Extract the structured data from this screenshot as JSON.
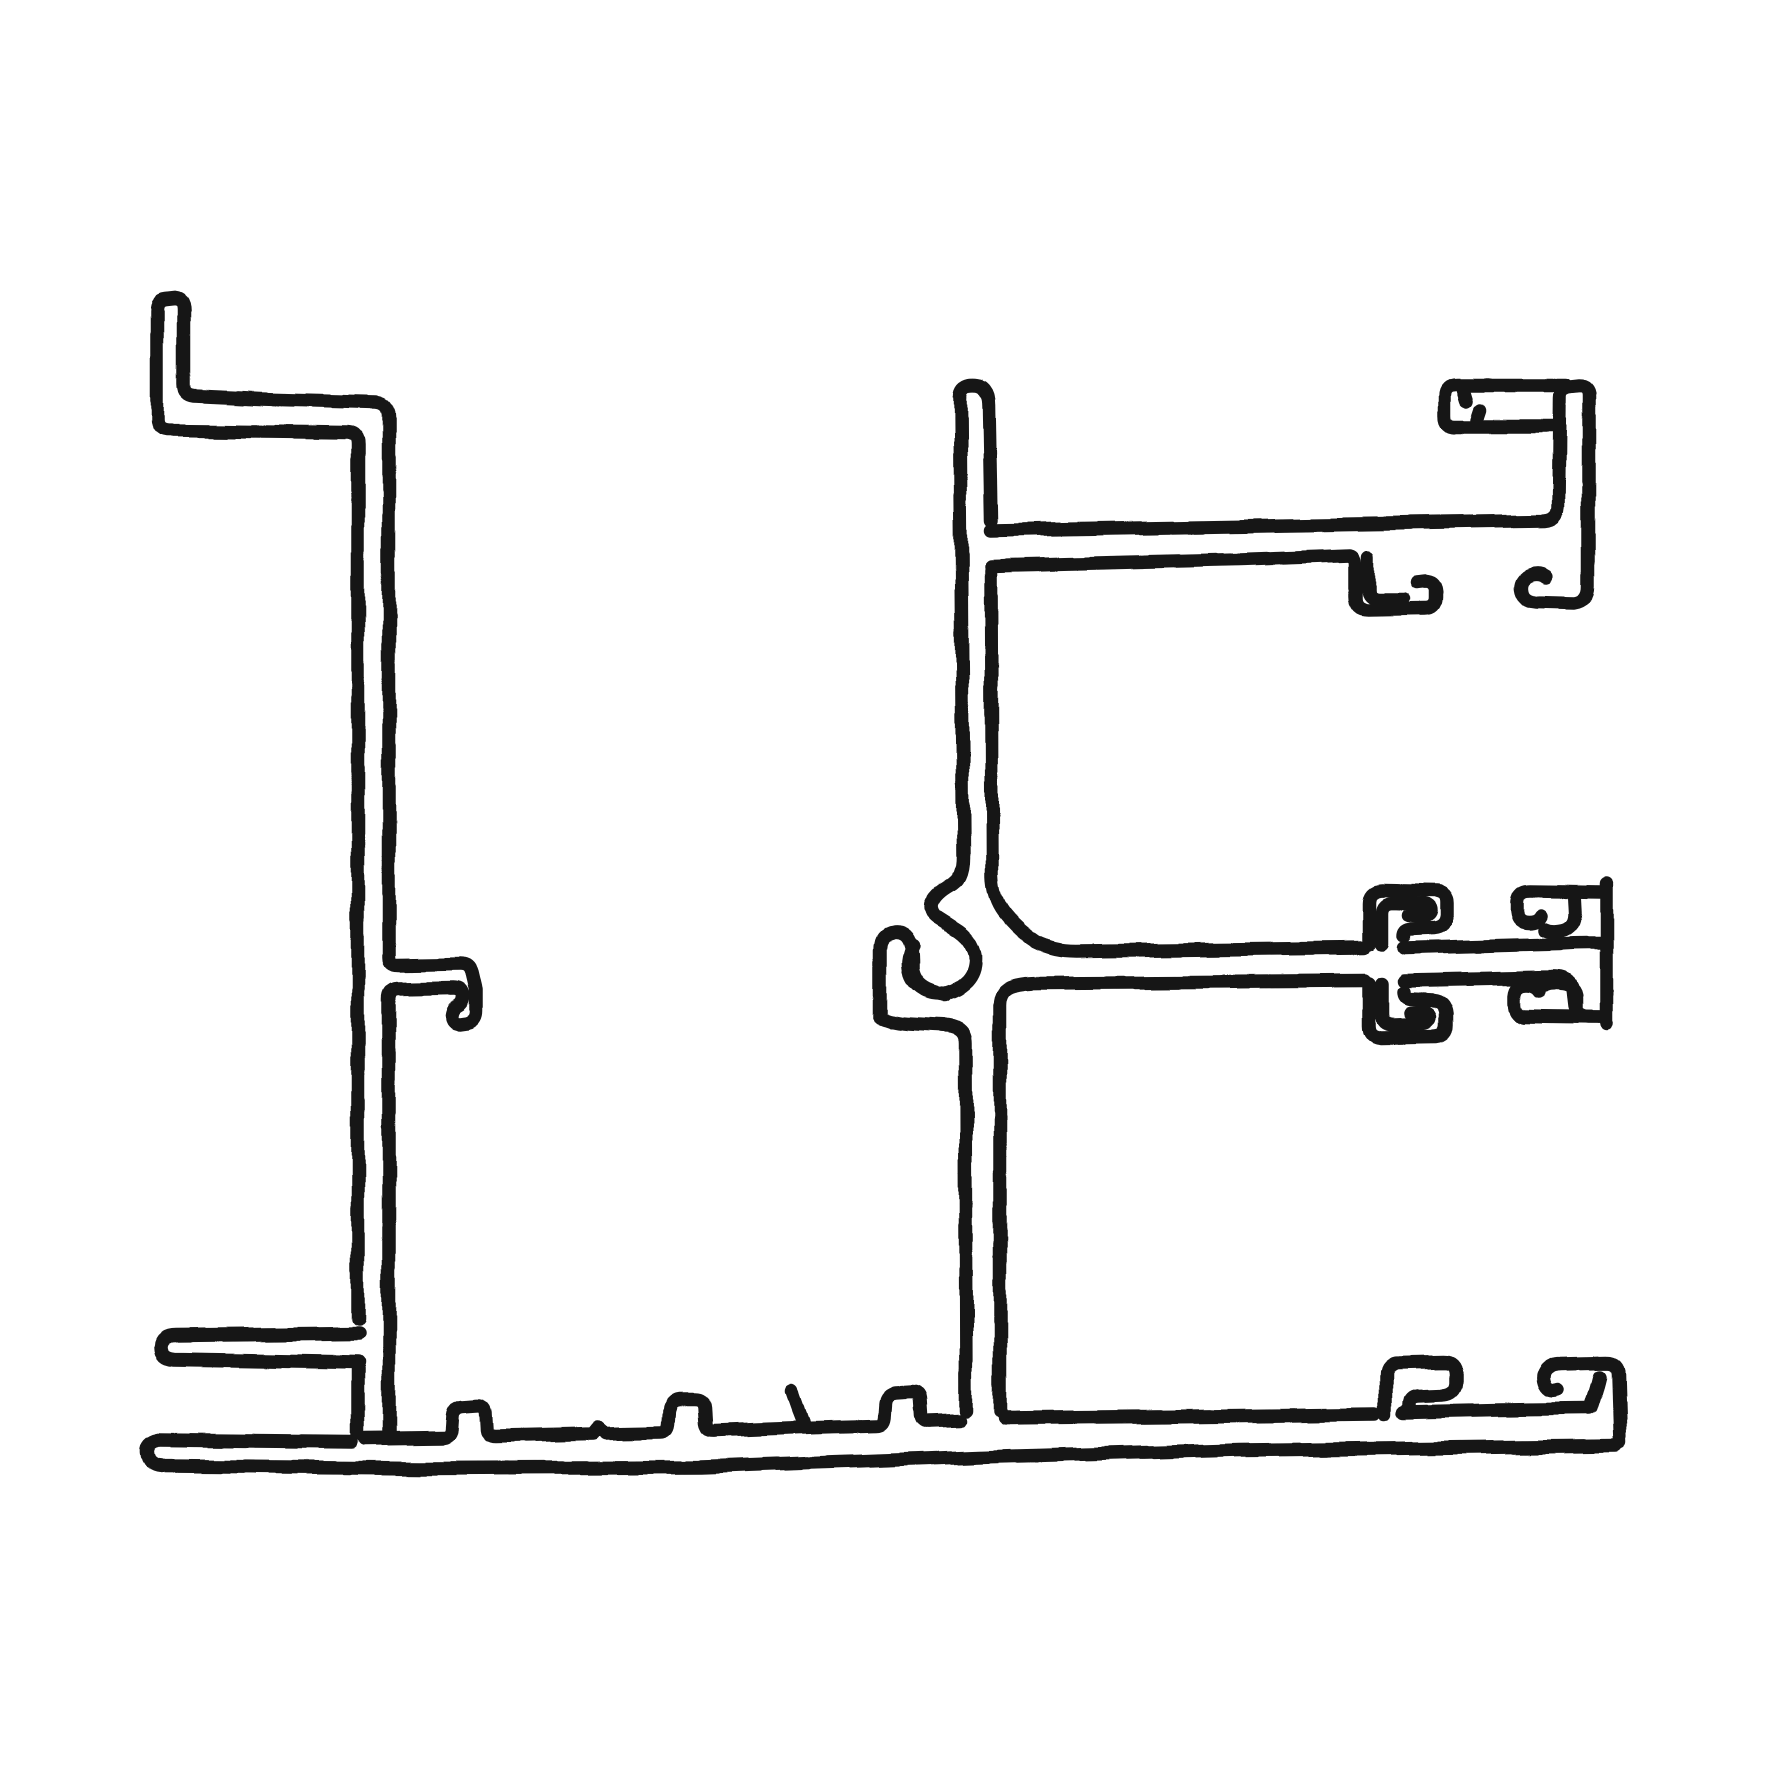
{
  "canvas": {
    "width": 1772,
    "height": 1772,
    "background": "#ffffff"
  },
  "drawing": {
    "description": "Hand-drawn black ink cross-section of an aluminium window-frame extrusion profile: a left Z-flanged upright, a long ribbed base sill, and a right upright carrying a glazing channel arm at top, a screw-boss hook and clip arm at middle, and bead-clip hooks at bottom right",
    "ink_color": "#191919",
    "stroke_width": 13.5,
    "paths": [
      {
        "name": "baseline-bottom-edge",
        "d": "M158,1440 Q146,1443 147,1453 Q148,1465 161,1466 L420,1468 L700,1467 L980,1457 L1240,1450 L1616,1446"
      },
      {
        "name": "baseline-top-edge-left",
        "d": "M158,1440 L352,1442"
      },
      {
        "name": "baseline-top-edge-mid-with-ribs",
        "d": "M366,1439 L442,1438 Q450,1438 451,1430 L452,1416 Q453,1407 462,1406 L476,1405 Q485,1404 486,1412 L487,1429 Q488,1436 496,1436 L592,1434 L598,1427 L605,1433 L661,1432 Q668,1432 669,1424 L670,1410 Q671,1401 680,1400 L695,1400 Q704,1400 705,1408 L706,1424 Q707,1431 715,1430 L800,1427 L876,1425 Q883,1425 884,1417 L885,1403 Q886,1394 895,1393 L911,1392 Q919,1392 920,1400 L921,1415 Q922,1422 930,1421 L960,1420"
      },
      {
        "name": "baseline-top-edge-right",
        "d": "M1004,1418 L1200,1416 L1376,1414"
      },
      {
        "name": "baseline-top-edge-far-right",
        "d": "M1404,1412 L1500,1410 L1589,1409"
      },
      {
        "name": "baseline-rib-flick",
        "d": "M791,1391 L797,1408 L804,1426"
      },
      {
        "name": "left-upright-outer-wall",
        "d": "M175,299 L166,300 Q157,301 157,311 L157,419 Q157,429 167,430 L348,432 Q358,433 358,444 L358,1320"
      },
      {
        "name": "left-bottom-finger",
        "d": "M358,1334 L176,1336 Q162,1336 161,1347 Q161,1358 174,1359 L358,1362"
      },
      {
        "name": "left-upright-wall-lower",
        "d": "M358,1368 L358,1434"
      },
      {
        "name": "left-upright-inner-wall-with-hook",
        "d": "M175,299 Q184,300 184,310 L184,385 Q184,395 194,396 L260,399 L376,402 Q389,403 389,417 L389,957 Q389,965 398,965 L461,964 Q470,964 472,973 L476,990 L476,1011 Q476,1021 466,1023 L459,1024 Q450,1024 451,1015 Q452,1008 458,1005 Q463,1002 463,995 Q462,988 454,988 L397,989 Q389,990 389,999 L389,1432"
      },
      {
        "name": "right-upright-cap-and-right-wall",
        "d": "M960,397 Q960,387 970,385 Q981,384 985,390 Q989,395 989,404 L991,520"
      },
      {
        "name": "right-upright-right-wall-to-clip-arm",
        "d": "M991,570 L992,876 Q993,900 1006,915 Q1019,931 1036,942 Q1054,951 1076,951 L1364,948"
      },
      {
        "name": "right-upright-left-wall-boss-curl",
        "d": "M960,397 L963,856 Q963,879 950,885 Q936,893 932,903 Q930,912 938,918 Q946,923 955,929 Q972,939 975,956 Q976,971 967,981 Q956,992 941,994 Q925,994 915,983 Q908,974 909,962 Q910,952 914,947"
      },
      {
        "name": "boss-j-hook",
        "d": "M881,1016 L881,949 Q881,935 894,933 Q906,932 910,943 Q913,951 913,961 L913,970 Q915,984 928,990 Q937,994 945,995"
      },
      {
        "name": "boss-channel-bottom-and-lower-left-wall",
        "d": "M881,1018 Q892,1023 908,1024 L948,1026 Q965,1028 965,1043 L966,1410"
      },
      {
        "name": "lower-right-wall-and-clip-arm-bottom",
        "d": "M1000,1412 L1000,1006 Q1000,990 1014,986 Q1025,983 1041,983 L1364,981"
      },
      {
        "name": "clip-arm-top-right-segment",
        "d": "M1404,948 L1560,944 Q1574,943 1588,943 L1601,943"
      },
      {
        "name": "clip-arm-bottom-right-step",
        "d": "M1404,981 L1552,978 Q1570,977 1572,989 L1574,1006 Q1576,1016 1588,1017 L1601,1017"
      },
      {
        "name": "clip-upper-barb-outer",
        "d": "M1369,944 L1369,903 Q1369,891 1381,890 L1436,891 Q1447,892 1447,903 L1447,915 Q1446,927 1434,928 L1410,929 Q1404,930 1404,936"
      },
      {
        "name": "clip-upper-barb-inner",
        "d": "M1382,944 L1382,914 Q1382,903 1394,903 L1423,904 Q1431,905 1431,911 Q1430,916 1423,916 L1410,915"
      },
      {
        "name": "clip-lower-barb-outer",
        "d": "M1369,984 L1369,1025 Q1369,1037 1381,1038 L1436,1037 Q1447,1036 1447,1025 L1447,1013 Q1446,1001 1434,1000 L1410,999 Q1404,998 1404,992"
      },
      {
        "name": "clip-lower-barb-inner",
        "d": "M1382,984 L1382,1014 Q1382,1025 1394,1025 L1423,1024 Q1431,1023 1431,1017 Q1430,1012 1423,1012 L1410,1013"
      },
      {
        "name": "mid-right-end-bar",
        "d": "M1607,884 L1607,1024"
      },
      {
        "name": "mid-right-top-band-with-curl",
        "d": "M1601,892 L1530,891 Q1518,891 1517,902 L1517,912 Q1518,923 1529,923 Q1538,923 1541,917"
      },
      {
        "name": "mid-right-top-barb",
        "d": "M1573,893 L1574,912 Q1575,928 1561,931 Q1551,933 1545,930"
      },
      {
        "name": "mid-right-bottom-band",
        "d": "M1524,1016 L1600,1017"
      },
      {
        "name": "mid-right-bottom-curl",
        "d": "M1524,1016 Q1515,1014 1515,1003 L1515,996 Q1516,985 1527,985 Q1536,985 1540,991"
      },
      {
        "name": "mid-right-bottom-barb",
        "d": "M1576,1011 L1576,998 Q1576,986 1562,984 Q1552,982 1546,985"
      },
      {
        "name": "top-arm-outline-and-end-hook",
        "d": "M991,530 L1290,525 L1545,521 Q1558,520 1559,508 L1560,398 Q1560,388 1570,387 L1579,386 Q1589,386 1589,396 L1589,586 Q1589,601 1575,603 L1536,602 Q1522,601 1521,589 Q1520,579 1530,575 Q1539,572 1546,577"
      },
      {
        "name": "top-arm-head-band-and-lip",
        "d": "M1565,385 L1456,385 Q1444,385 1444,396 L1444,415 Q1444,426 1455,426 L1553,426"
      },
      {
        "name": "top-arm-pocket-barb-1",
        "d": "M1463,391 L1466,401"
      },
      {
        "name": "top-arm-pocket-barb-2",
        "d": "M1477,419 L1480,410"
      },
      {
        "name": "top-arm-bottom-edge-and-bead-hook",
        "d": "M991,566 L1240,560 L1350,556 Q1355,557 1355,566 L1355,597 Q1355,610 1368,610 L1426,609 Q1437,609 1437,598 L1437,590 Q1436,581 1426,581 L1417,582"
      },
      {
        "name": "top-arm-bead-hook-inner",
        "d": "M1368,557 L1368,588 Q1368,599 1379,599 L1404,599"
      },
      {
        "name": "bottom-right-c-hook",
        "d": "M1386,1414 L1386,1375 Q1386,1363 1398,1363 L1443,1362 Q1455,1362 1455,1374 L1455,1383 Q1454,1394 1442,1395 L1417,1396 Q1409,1397 1409,1404 L1409,1411"
      },
      {
        "name": "bottom-right-end-band-with-curl",
        "d": "M1557,1390 Q1548,1393 1544,1385 Q1540,1375 1546,1369 Q1551,1364 1561,1364 L1606,1363 Q1618,1363 1618,1375 L1620,1443"
      },
      {
        "name": "bottom-right-end-inner-wall",
        "d": "M1600,1377 Q1597,1390 1591,1408"
      }
    ]
  }
}
